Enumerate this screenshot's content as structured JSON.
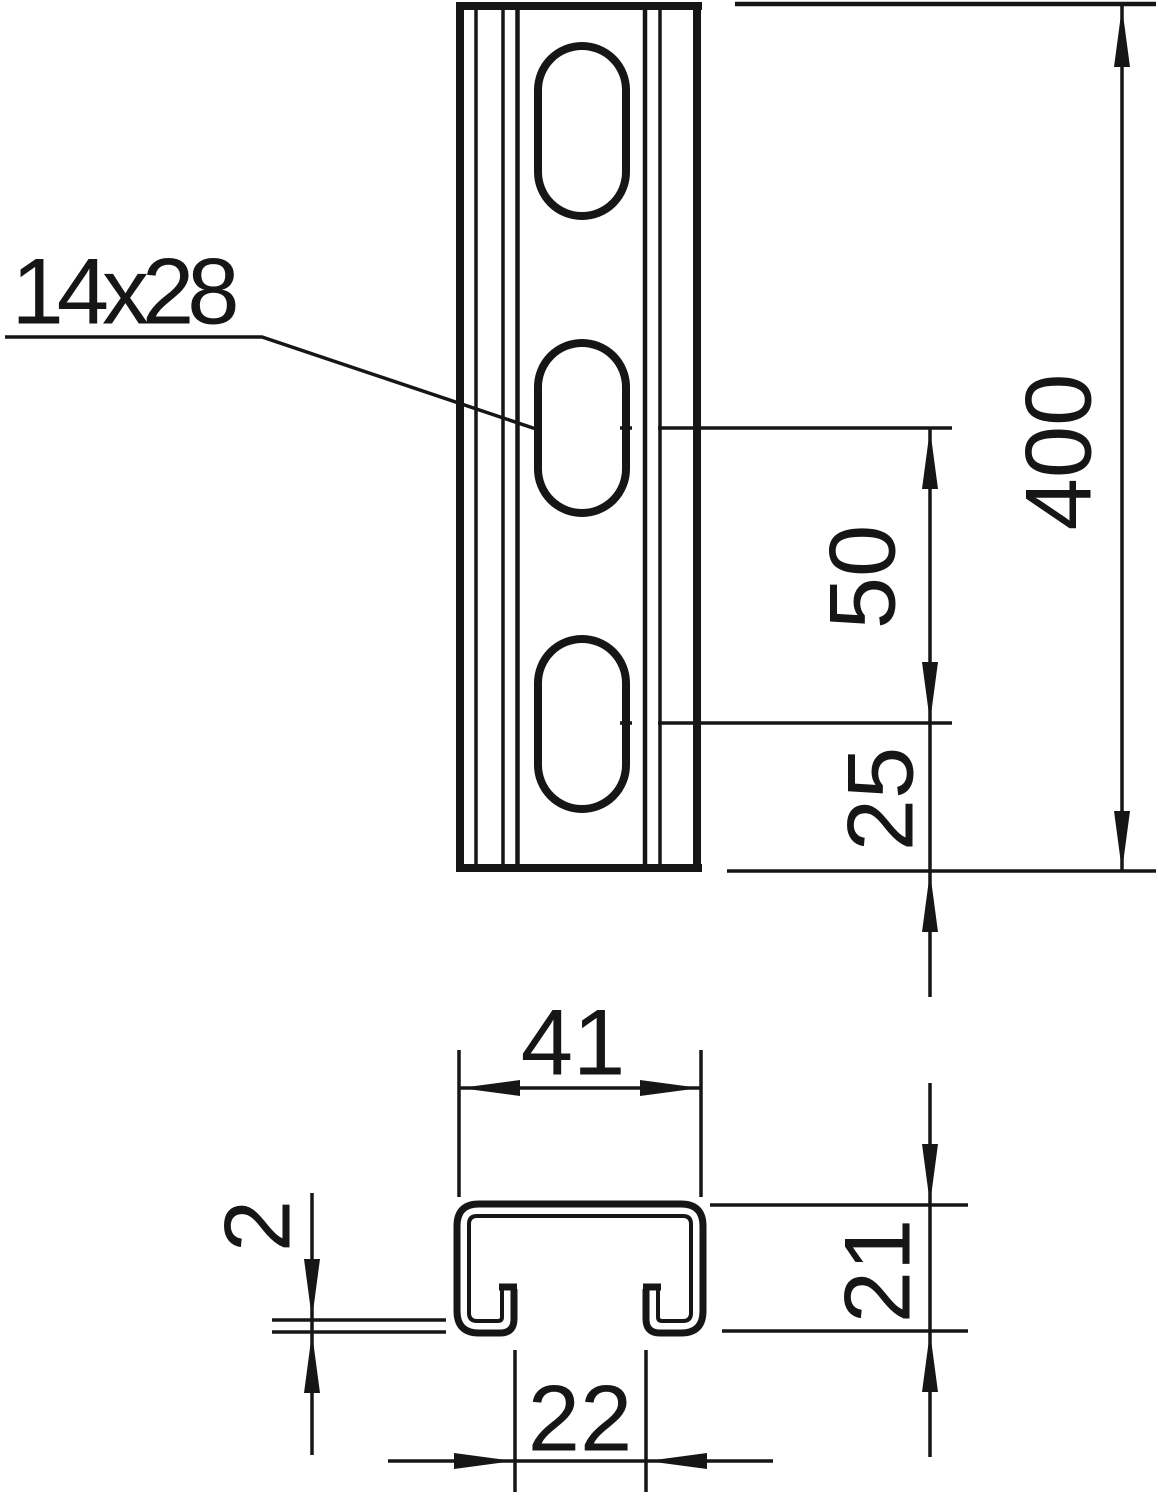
{
  "drawing": {
    "callout": {
      "slot_size": "14x28"
    },
    "dimensions": {
      "total_length": "400",
      "hole_pitch": "50",
      "hole_end_distance": "25",
      "profile_width": "41",
      "wall_thickness": "2",
      "profile_height": "21",
      "slot_opening": "22"
    },
    "colors": {
      "line": "#161616",
      "background": "#ffffff"
    }
  }
}
